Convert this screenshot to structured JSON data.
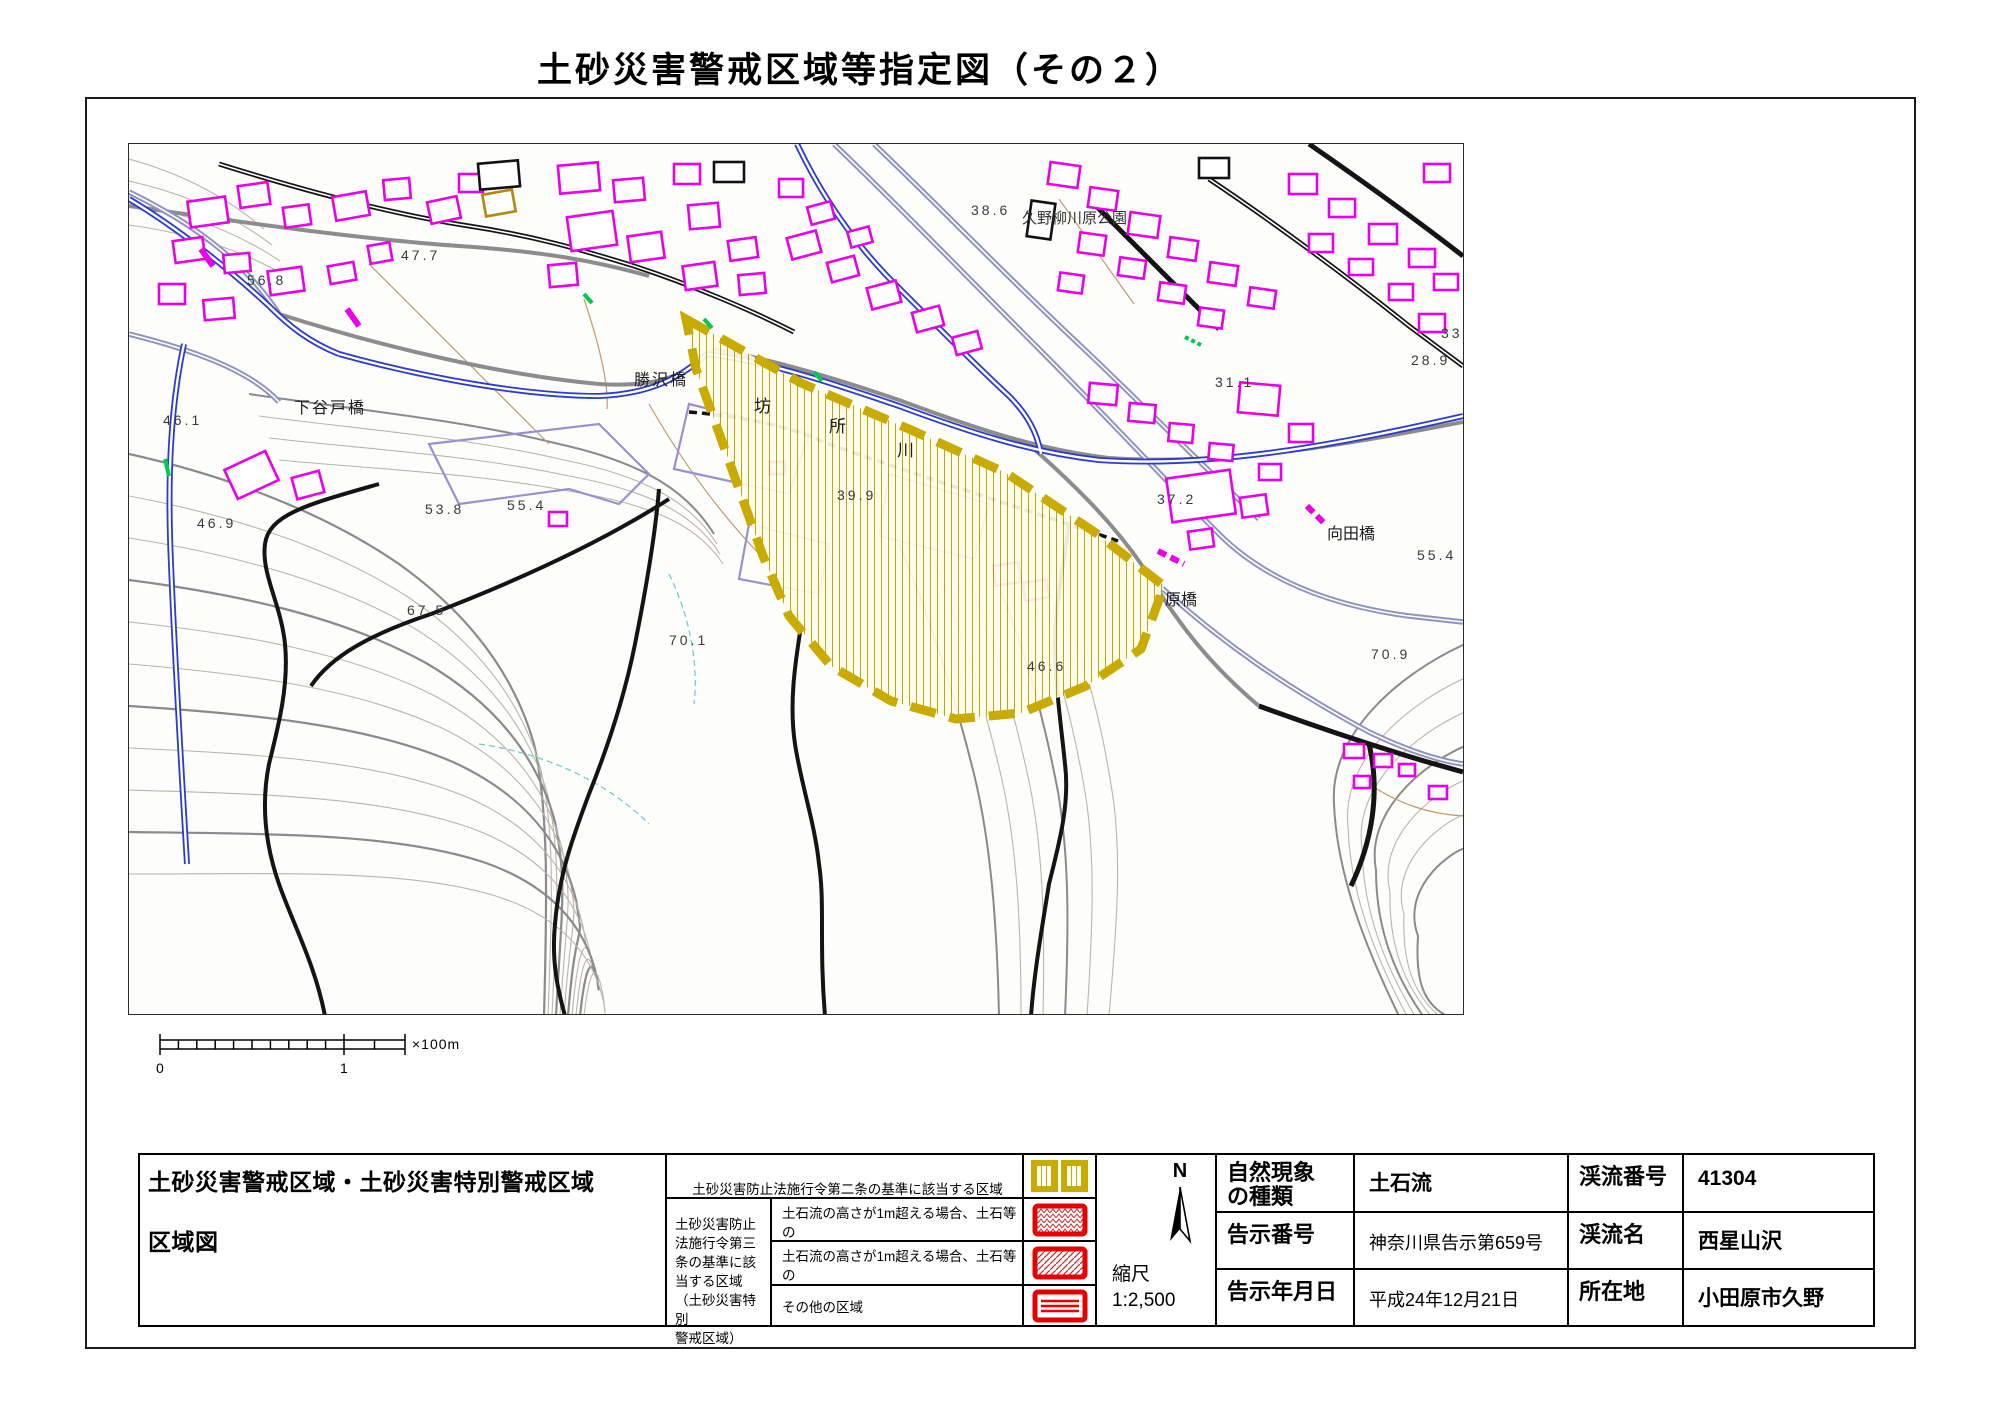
{
  "title": "土砂災害警戒区域等指定図（その２）",
  "compass": {
    "label": "N"
  },
  "scale_bar": {
    "zero": "0",
    "one": "1",
    "unit": "×100m"
  },
  "map": {
    "labels": [
      {
        "cls": "elev",
        "x": 118,
        "y": 128,
        "text": "56.8"
      },
      {
        "cls": "elev",
        "x": 272,
        "y": 103,
        "text": "47.7"
      },
      {
        "cls": "elev",
        "x": 842,
        "y": 58,
        "text": "38.6"
      },
      {
        "cls": "elev",
        "x": 1312,
        "y": 181,
        "text": "33.6"
      },
      {
        "cls": "elev",
        "x": 1282,
        "y": 208,
        "text": "28.9"
      },
      {
        "cls": "elev",
        "x": 1086,
        "y": 230,
        "text": "31.1"
      },
      {
        "cls": "elev",
        "x": 34,
        "y": 268,
        "text": "46.1"
      },
      {
        "cls": "elev",
        "x": 68,
        "y": 371,
        "text": "46.9"
      },
      {
        "cls": "elev",
        "x": 296,
        "y": 357,
        "text": "53.8"
      },
      {
        "cls": "elev",
        "x": 378,
        "y": 353,
        "text": "55.4"
      },
      {
        "cls": "elev",
        "x": 708,
        "y": 343,
        "text": "39.9"
      },
      {
        "cls": "elev",
        "x": 1028,
        "y": 347,
        "text": "37.2"
      },
      {
        "cls": "elev",
        "x": 1288,
        "y": 403,
        "text": "55.4"
      },
      {
        "cls": "elev",
        "x": 898,
        "y": 514,
        "text": "46.6"
      },
      {
        "cls": "elev",
        "x": 540,
        "y": 488,
        "text": "70.1"
      },
      {
        "cls": "elev",
        "x": 278,
        "y": 458,
        "text": "67.5"
      },
      {
        "cls": "elev",
        "x": 1242,
        "y": 502,
        "text": "70.9"
      },
      {
        "cls": "bridge",
        "x": 165,
        "y": 250,
        "text": "下谷戸橋"
      },
      {
        "cls": "bridge",
        "x": 505,
        "y": 222,
        "text": "勝沢橋"
      },
      {
        "cls": "vert",
        "x": 1198,
        "y": 380,
        "text": "向田橋"
      },
      {
        "cls": "vert",
        "x": 1036,
        "y": 446,
        "text": "原橋"
      },
      {
        "cls": "river",
        "x": 625,
        "y": 248,
        "text": "坊"
      },
      {
        "cls": "river",
        "x": 700,
        "y": 268,
        "text": "所"
      },
      {
        "cls": "river",
        "x": 768,
        "y": 292,
        "text": "川"
      },
      {
        "cls": "park",
        "x": 893,
        "y": 64,
        "text": "久野柳川原公園"
      }
    ]
  },
  "table": {
    "title_line1": "土砂災害警戒区域・土砂災害特別警戒区域",
    "title_line2": "区域図",
    "legend": {
      "head_line1": "土砂災害防止法施行令第二条の基準に該当する区域",
      "head_line2": "（土砂災害警戒区域）",
      "group_label": "土砂災害防止\n法施行令第三\n条の基準に該\n当する区域\n（土砂災害特別\n警戒区域）",
      "rows": [
        {
          "text": "土石流の高さが1m超える場合、土石等の\n移動による力が50kN/㎡を超える区域",
          "swatch": "red-crosshatch"
        },
        {
          "text": "土石流の高さが1m超える場合、土石等の\n移動による力が50kN/㎡を超えない区域",
          "swatch": "red-diagonal"
        },
        {
          "text": "その他の区域",
          "swatch": "red-horizontal"
        }
      ]
    },
    "scale": {
      "label": "縮尺",
      "value": "1:2,500"
    },
    "fields": [
      {
        "label": "自然現象\nの種類",
        "value": "土石流"
      },
      {
        "label": "告示番号",
        "value": "神奈川県告示第659号"
      },
      {
        "label": "告示年月日",
        "value": "平成24年12月21日"
      },
      {
        "label": "渓流番号",
        "value": "41304"
      },
      {
        "label": "渓流名",
        "value": "西星山沢"
      },
      {
        "label": "所在地",
        "value": "小田原市久野"
      }
    ]
  },
  "colors": {
    "building": "#e800e8",
    "river": "#2b3bd0",
    "hazard_border": "#c9ab00",
    "hazard_hatch": "#b5a000",
    "special_zone_red": "#e60000"
  }
}
